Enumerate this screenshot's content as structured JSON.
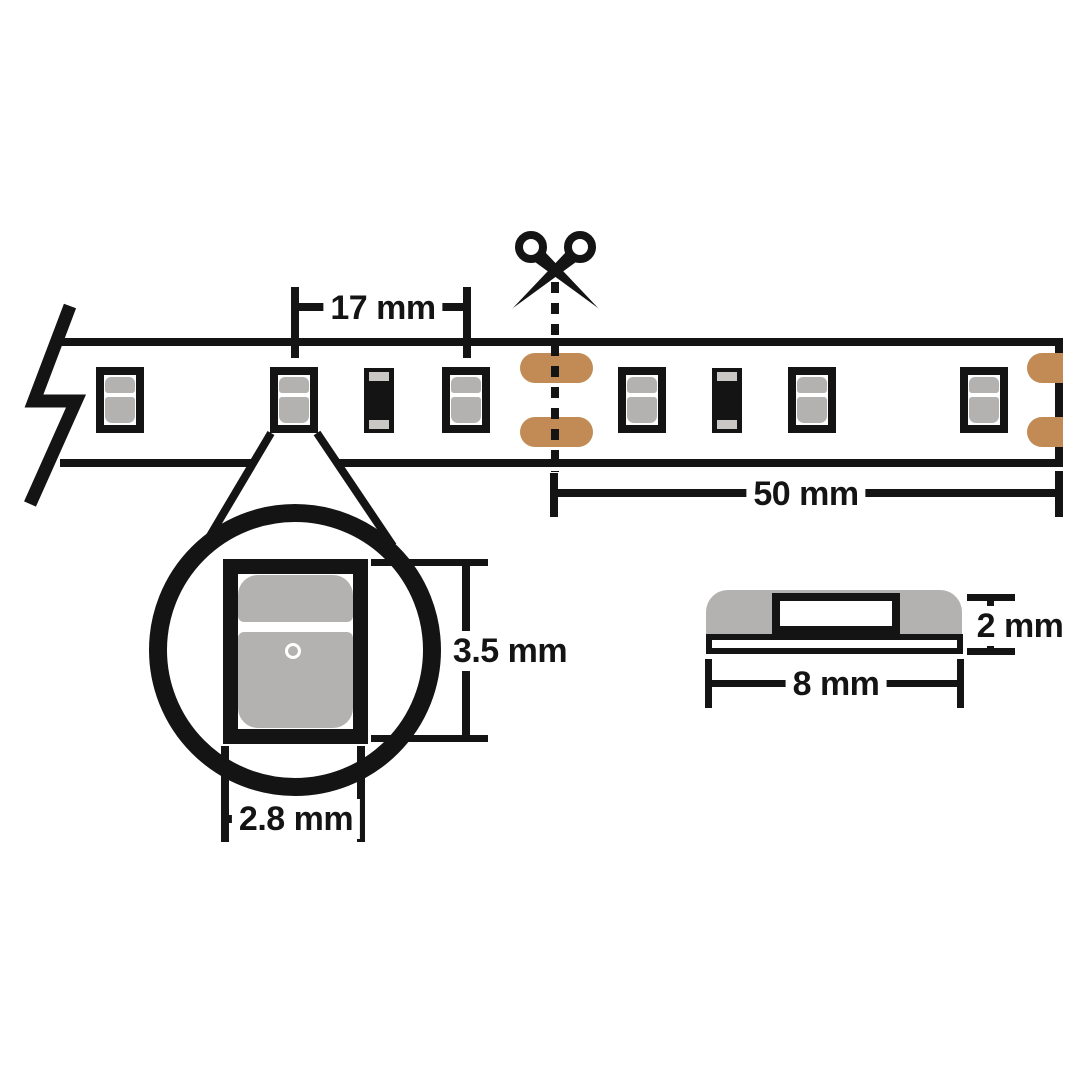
{
  "diagram": {
    "labels": {
      "led_pitch": "17 mm",
      "cut_segment_length": "50 mm",
      "led_chip_height": "3.5 mm",
      "led_chip_width": "2.8 mm",
      "strip_profile_height": "2 mm",
      "strip_profile_width": "8 mm"
    },
    "colors": {
      "line-black": "#141414",
      "led-gray": "#B3B2B0",
      "resistor-cap-gray": "#C9C8C5",
      "copper": "#C28B55",
      "background": "#FFFFFF"
    },
    "components": {
      "leds": 6,
      "resistors": 2,
      "solder_pad_pairs_at_cut": 1,
      "solder_pad_pairs_at_end": 1
    },
    "icons": {
      "scissors": "scissors-icon",
      "strip_break": "strip-break-zigzag-icon",
      "magnifier": "magnifier-circle"
    }
  }
}
